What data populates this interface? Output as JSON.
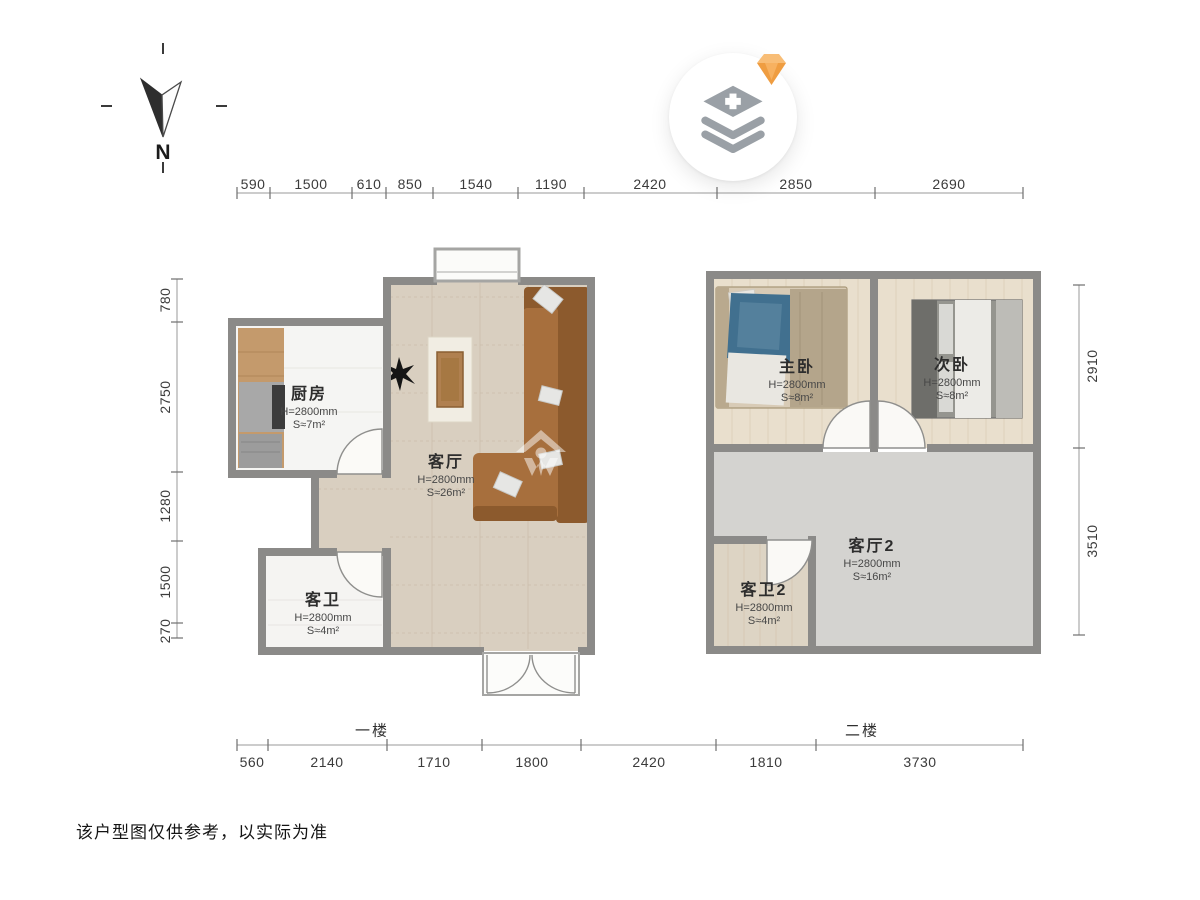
{
  "canvas": {
    "disclaimer": "该户型图仅供参考，以实际为准"
  },
  "compass": {
    "label": "N"
  },
  "floor_labels": {
    "first": "一楼",
    "second": "二楼"
  },
  "dimensions": {
    "top": [
      "590",
      "1500",
      "610",
      "850",
      "1540",
      "1190",
      "2420",
      "2850",
      "2690"
    ],
    "bottom": [
      "560",
      "2140",
      "1710",
      "1800",
      "2420",
      "1810",
      "3730"
    ],
    "left": [
      "780",
      "2750",
      "1280",
      "1500",
      "270"
    ],
    "right": [
      "2910",
      "3510"
    ]
  },
  "rooms": {
    "kitchen": {
      "name": "厨房",
      "height": "H=2800mm",
      "area": "S≈7m²"
    },
    "living": {
      "name": "客厅",
      "height": "H=2800mm",
      "area": "S≈26m²"
    },
    "bath1": {
      "name": "客卫",
      "height": "H=2800mm",
      "area": "S≈4m²"
    },
    "master": {
      "name": "主卧",
      "height": "H=2800mm",
      "area": "S≈8m²"
    },
    "second": {
      "name": "次卧",
      "height": "H=2800mm",
      "area": "S≈8m²"
    },
    "living2": {
      "name": "客厅2",
      "height": "H=2800mm",
      "area": "S≈16m²"
    },
    "bath2": {
      "name": "客卫2",
      "height": "H=2800mm",
      "area": "S≈4m²"
    }
  },
  "colors": {
    "wall": "#8b8a88",
    "tile_floor": "#d9cfc0",
    "marble_floor": "#f5f5f3",
    "wood_floor": "#e9dfcd",
    "gray_floor": "#d4d3d0",
    "sofa": "#a76f3d",
    "gem_orange": "#f2a24a",
    "icon_gray": "#9aa0a6"
  }
}
